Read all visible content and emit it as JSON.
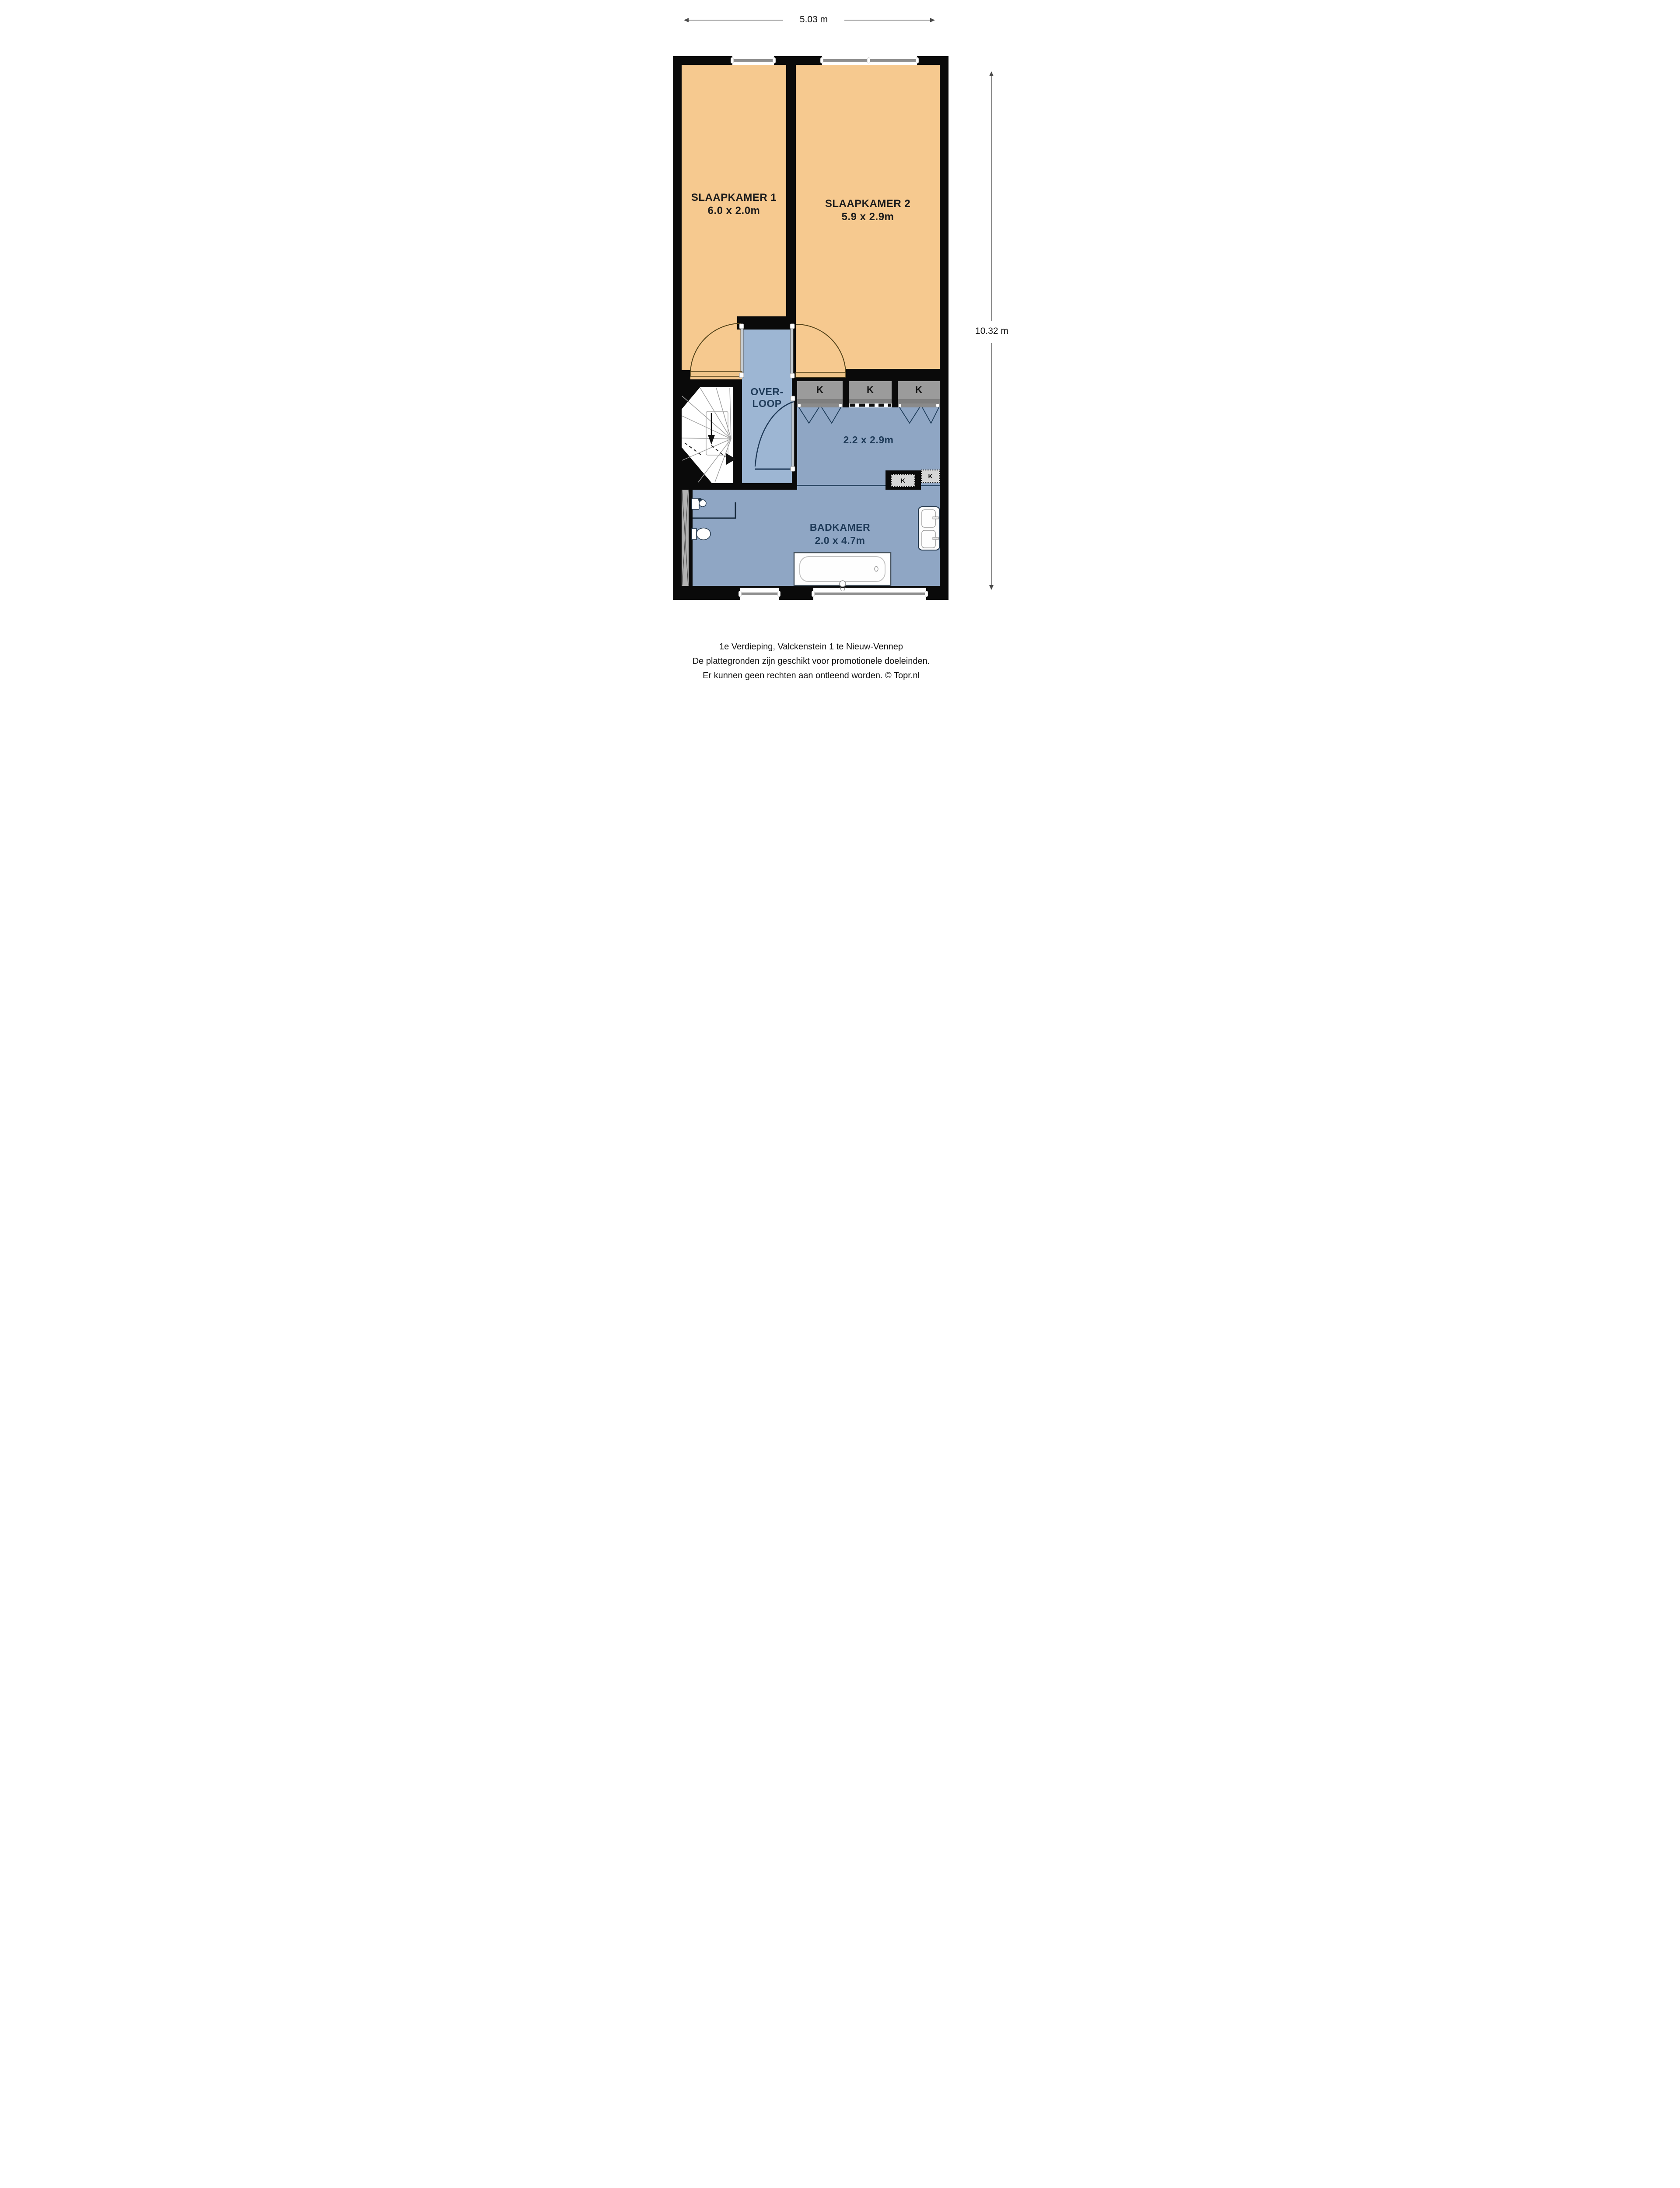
{
  "dimensions": {
    "width": "5.03 m",
    "height": "10.32 m"
  },
  "rooms": {
    "slaapkamer1": {
      "name": "SLAAPKAMER 1",
      "size": "6.0 x 2.0m"
    },
    "slaapkamer2": {
      "name": "SLAAPKAMER 2",
      "size": "5.9 x 2.9m"
    },
    "overloop": {
      "line1": "OVER-",
      "line2": "LOOP"
    },
    "hal": {
      "size": "2.2 x 2.9m"
    },
    "badkamer": {
      "name": "BADKAMER",
      "size": "2.0 x 4.7m"
    }
  },
  "closets": {
    "top": [
      {
        "label": "K"
      },
      {
        "label": "K"
      },
      {
        "label": "K"
      }
    ],
    "bottom": [
      {
        "label": "K"
      },
      {
        "label": "K"
      }
    ]
  },
  "caption": {
    "line1": "1e Verdieping, Valckenstein 1 te Nieuw-Vennep",
    "line2": "De plattegronden zijn geschikt voor promotionele doeleinden.",
    "line3": "Er kunnen geen rechten aan ontleend worden. © Topr.nl"
  },
  "colors": {
    "wall": "#0A0A0A",
    "bedroom": "#F6C98F",
    "hall_blue": "#9DB6D3",
    "room_blue": "#8FA6C4",
    "closet_gray": "#9B9B9B",
    "closet_light": "#D6D6D6",
    "accent_navy": "#1E3A58"
  }
}
